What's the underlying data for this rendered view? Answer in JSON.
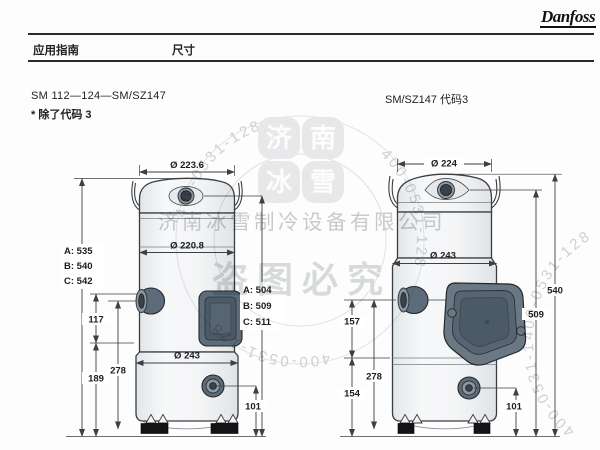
{
  "page": {
    "brand": "Danfoss",
    "header_left": "应用指南",
    "header_center": "尺寸"
  },
  "left_drawing": {
    "title": "SM 112—124—SM/SZ147",
    "note": "* 除了代码 3",
    "dims": {
      "top_diameter": "Ø 223.6",
      "shell_diameter": "Ø 220.8",
      "base_diameter": "Ø 243",
      "overall_heights": [
        "A: 535",
        "B: 540",
        "C: 542"
      ],
      "port_heights": [
        "A: 504",
        "B: 509",
        "C: 511"
      ],
      "suction_upper": "117",
      "suction_to_base": "278",
      "lower_section": "189",
      "sight_glass_height": "101"
    }
  },
  "right_drawing": {
    "title": "SM/SZ147 代码3",
    "dims": {
      "top_diameter": "Ø 224",
      "base_diameter": "Ø 243",
      "overall_height": "540",
      "port_height": "509",
      "suction_upper": "157",
      "suction_to_base": "278",
      "lower_section": "154",
      "sight_glass_height": "101"
    }
  },
  "watermark": {
    "phone": "400-0531-128",
    "company": "济南冰雪制冷设备有限公司",
    "warning": "盗图必究",
    "flower": [
      "济",
      "南",
      "冰",
      "雪"
    ]
  },
  "colors": {
    "slate_fitting": "#5d6c7a",
    "outline": "#383d42",
    "watermark_gray": "#c9cccf"
  }
}
